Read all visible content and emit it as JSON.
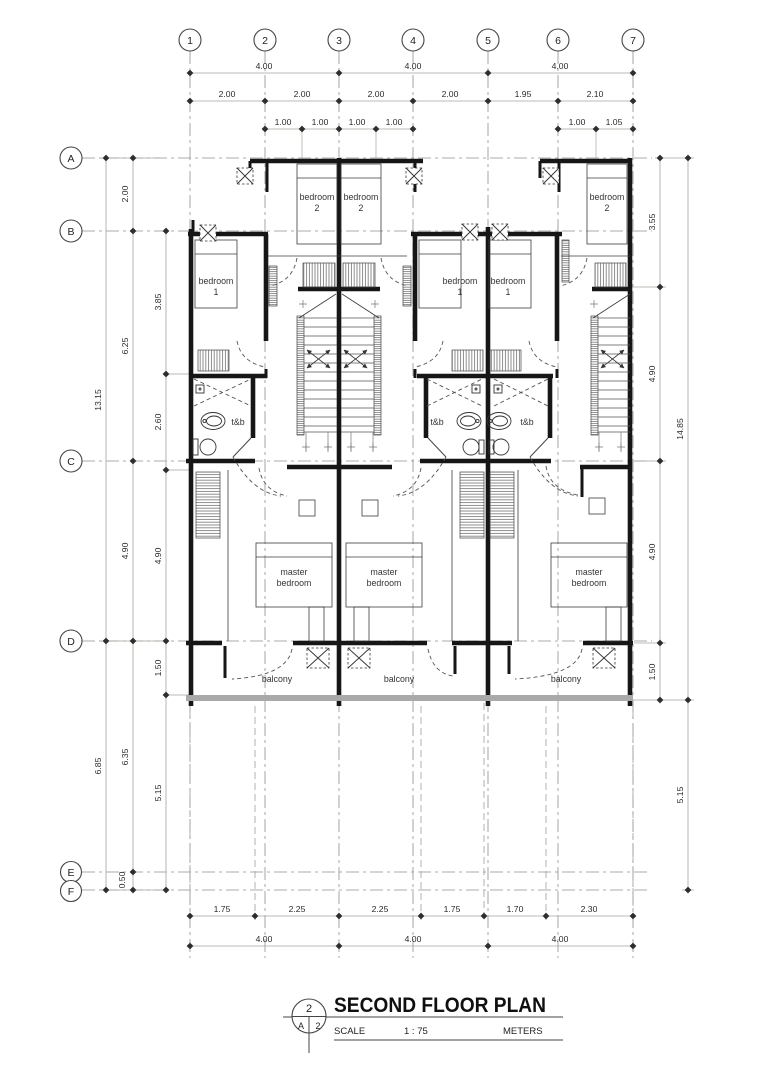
{
  "grid": {
    "cols": [
      "1",
      "2",
      "3",
      "4",
      "5",
      "6",
      "7"
    ],
    "rows": [
      "A",
      "B",
      "C",
      "D",
      "E",
      "F"
    ]
  },
  "dims": {
    "top1": [
      "4.00",
      "4.00",
      "4.00"
    ],
    "top2": [
      "2.00",
      "2.00",
      "2.00",
      "2.00",
      "1.95",
      "2.10"
    ],
    "top3_left": [
      "1.00",
      "1.00",
      "1.00",
      "1.00"
    ],
    "top3_right": [
      "1.00",
      "1.05"
    ],
    "left_outer": [
      "13.15",
      "6.85"
    ],
    "left_mid": [
      "2.00",
      "6.25",
      "4.90",
      "6.35",
      "0.50"
    ],
    "left_inner": [
      "3.85",
      "2.60",
      "4.90",
      "1.50",
      "5.15"
    ],
    "right_inner": [
      "3.55",
      "4.90",
      "4.90",
      "1.50"
    ],
    "right_outer": [
      "14.85",
      "5.15"
    ],
    "bottom1": [
      "1.75",
      "2.25",
      "2.25",
      "1.75",
      "1.70",
      "2.30"
    ],
    "bottom2": [
      "4.00",
      "4.00",
      "4.00"
    ]
  },
  "rooms": {
    "bedroom2": [
      "bedroom",
      "2"
    ],
    "bedroom1": [
      "bedroom",
      "1"
    ],
    "master": [
      "master",
      "bedroom"
    ],
    "tb": "t&b",
    "balcony": "balcony"
  },
  "title": {
    "name": "SECOND FLOOR PLAN",
    "scale_label": "SCALE",
    "scale_value": "1 : 75",
    "units_label": "METERS",
    "sheet_number": "2",
    "sheet_ref_left": "A",
    "sheet_ref_right": "2"
  }
}
